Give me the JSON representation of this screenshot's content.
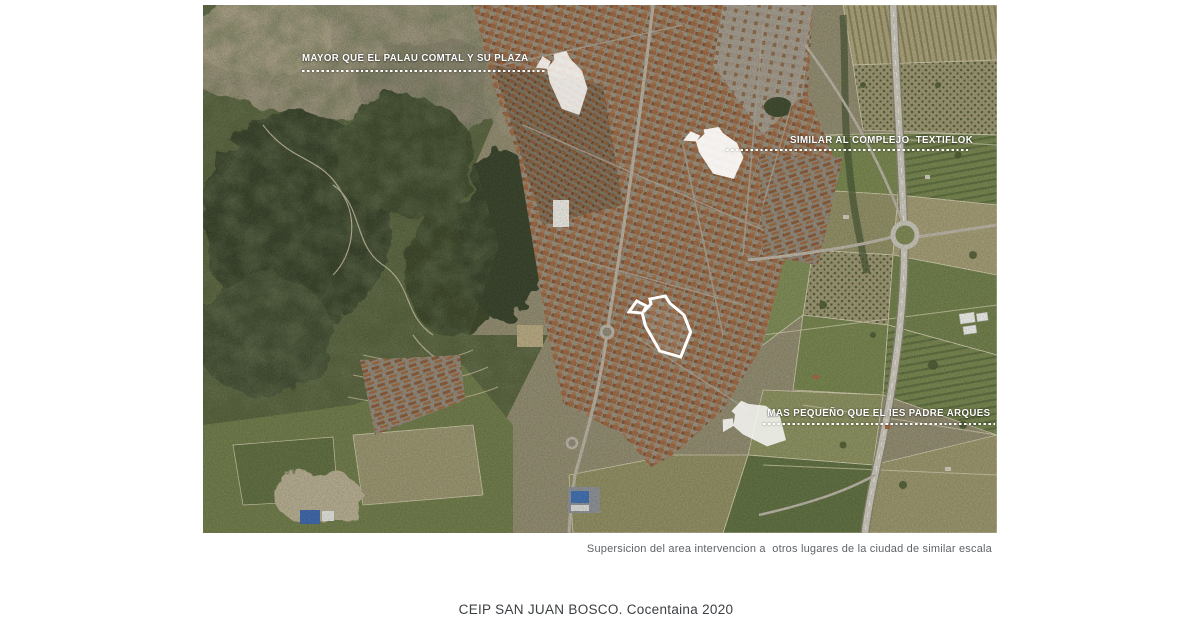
{
  "slide": {
    "title": "CEIP SAN JUAN BOSCO. Cocentaina 2020",
    "figure_caption": "Supersicion del area intervencion a  otros lugares de la ciudad de similar escala"
  },
  "map": {
    "kind": "aerial-satellite-photo",
    "annotations": [
      {
        "id": "palau-comtal",
        "label": "MAYOR QUE EL PALAU COMTAL Y SU PLAZA"
      },
      {
        "id": "textiflok",
        "label": "SIMILAR AL COMPLEJO  TEXTIFLOK"
      },
      {
        "id": "ies-padre-arques",
        "label": "MAS PEQUEÑO QUE EL IES PADRE ARQUES"
      }
    ],
    "overlays": [
      {
        "id": "overlay-palau",
        "meaning": "intervention footprint over Palau Comtal square"
      },
      {
        "id": "overlay-textiflok",
        "meaning": "intervention footprint over Textiflok complex"
      },
      {
        "id": "overlay-ies",
        "meaning": "intervention footprint over IES Padre Arques"
      },
      {
        "id": "intervention-site",
        "meaning": "white outlined intervention area in town centre"
      }
    ],
    "colors": {
      "annotation_text": "#ffffff",
      "overlay_fill": "#ffffff",
      "caption_text": "#5f6368",
      "title_text": "#3c4043"
    }
  }
}
